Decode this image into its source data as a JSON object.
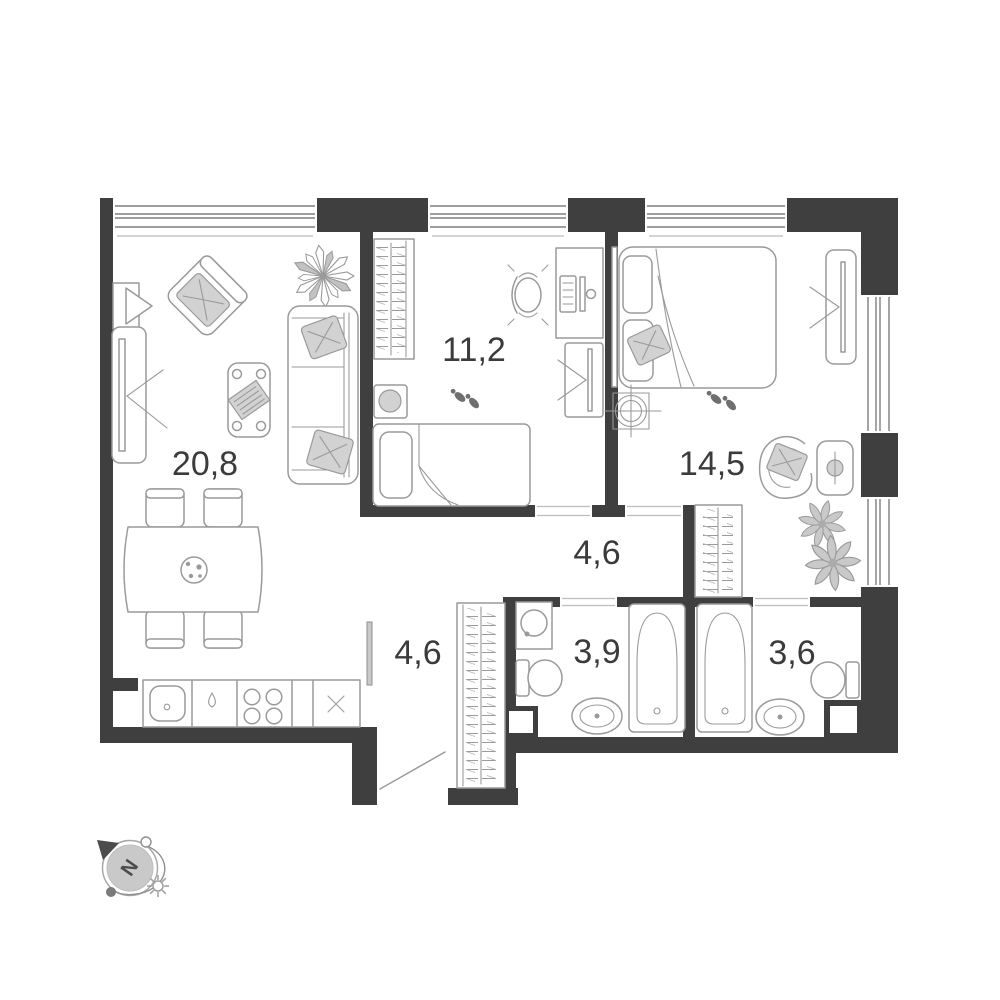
{
  "plan_title": "apartment-floor-plan",
  "colors": {
    "wall": "#3f3f3f",
    "line": "#9a9a9a",
    "label": "#3b3b3b",
    "fill-soft": "#d2d2d2"
  },
  "rooms": {
    "living": "20,8",
    "bedroom": "11,2",
    "master_bedroom": "14,5",
    "hallway": "4,6",
    "corridor": "4,6",
    "bathroom": "3,9",
    "ensuite_bathroom": "3,6"
  },
  "compass": {
    "north_label": "N"
  }
}
